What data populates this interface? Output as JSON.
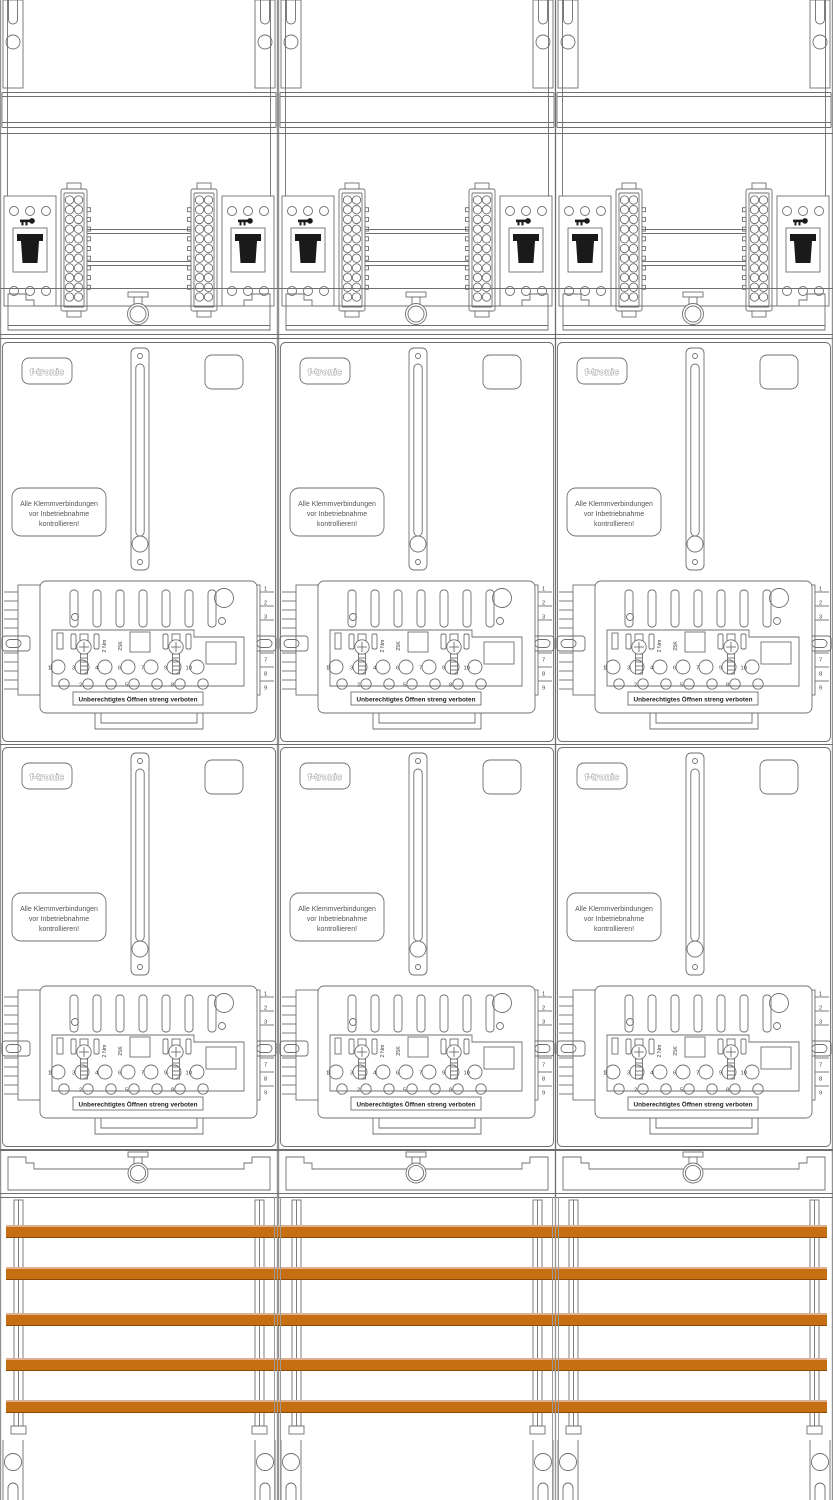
{
  "cabinet": {
    "brand": "f-tronic",
    "columns": 3,
    "meter_rows_per_column": 2,
    "inspection_label": {
      "line1": "Alle Klemmverbindungen",
      "line2": "vor Inbetriebnahme",
      "line3": "kontrollieren!"
    },
    "terminal_block": {
      "seal_warning": "Unberechtigtes Öffnen streng verboten",
      "torque": "2 Nm",
      "type": "25K",
      "terminal_numbers": [
        "1",
        "3",
        "4",
        "6",
        "7",
        "9",
        "10"
      ],
      "bottom_terminal_numbers": [
        "2",
        "5",
        "8"
      ]
    },
    "wire_comb": {
      "top_numbers": [
        "1",
        "2",
        "3"
      ],
      "middle_number": "5",
      "bottom_numbers": [
        "7",
        "8",
        "9"
      ]
    },
    "busbars": {
      "count": 5,
      "color": "#C66F12",
      "edge_color": "#8A4A08",
      "highlight_color": "#DDB091",
      "y_positions_px": [
        1225,
        1267,
        1313,
        1358,
        1400
      ],
      "height_px": 13
    },
    "line_color": "#6F6F6F",
    "background": "#FFFFFF"
  }
}
